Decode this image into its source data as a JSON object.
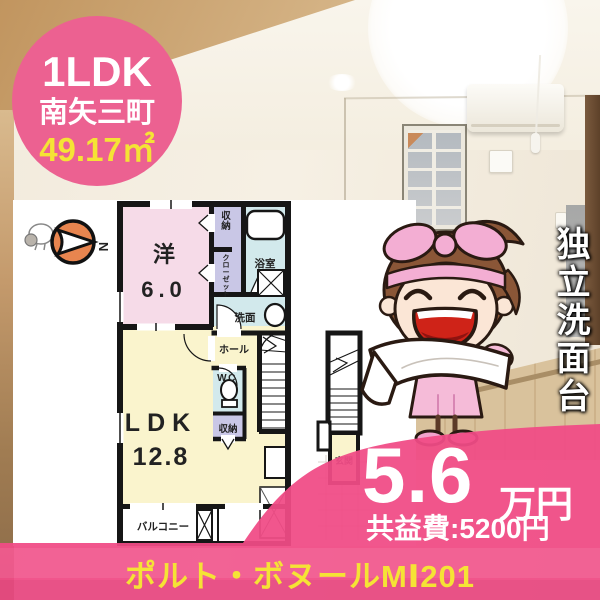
{
  "badge": {
    "type": "1LDK",
    "town": "南矢三町",
    "area": "49.17㎡"
  },
  "floor_plan": {
    "compass_label": "N",
    "labels": {
      "bedroom": "洋",
      "bedroom_size": "6.0",
      "storage_top": "収納",
      "closet": "クローゼット",
      "bath": "浴室",
      "washroom": "洗面",
      "hall": "ホール",
      "wc": "WC",
      "storage_mid": "収納",
      "ldk": "LDK",
      "ldk_size": "12.8",
      "balcony": "バルコニー",
      "entrance": "玄関"
    }
  },
  "feature_vertical_label": "独立洗面台",
  "price": {
    "rent": "5.6",
    "unit": "万円",
    "common_fee": "共益費:5200円"
  },
  "building_name": "ポルト・ボヌールMⅠ201",
  "colors": {
    "accent_pink": "#ec6191",
    "overlay_pink": "#f04b86",
    "highlight_yellow": "#f5e335",
    "room_pink": "#f6dbe8",
    "room_yellow": "#faf4cd",
    "room_lavender": "#c9c7e6",
    "room_cyan": "#d2e9ec",
    "compass_orange": "#e8854f"
  }
}
